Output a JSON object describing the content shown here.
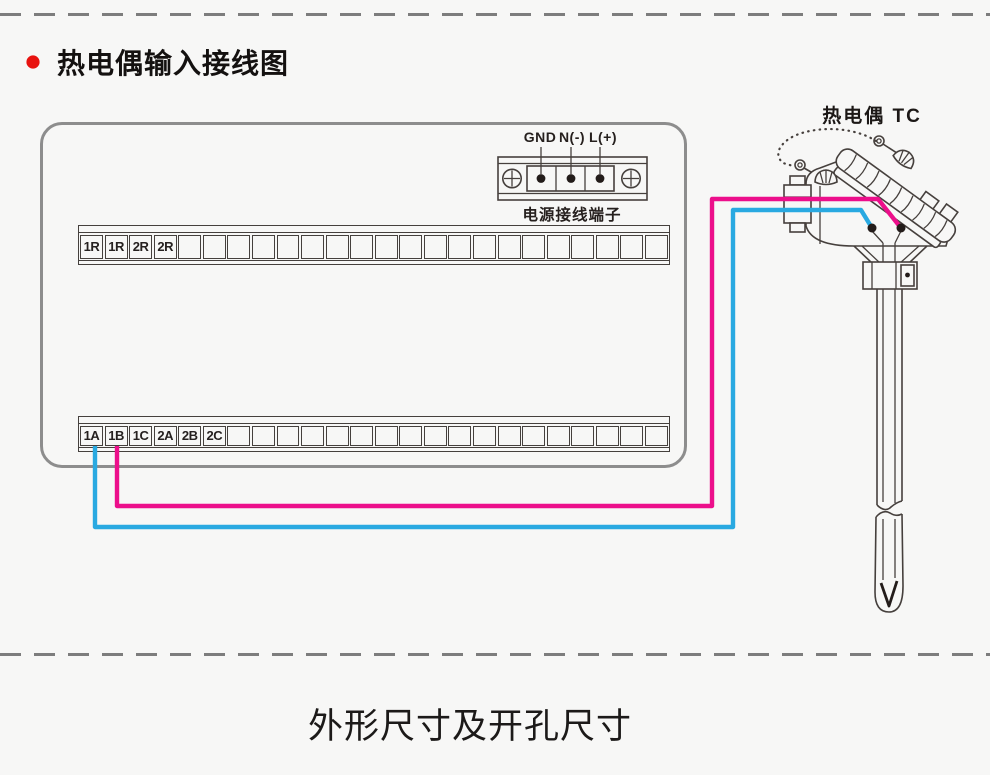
{
  "page": {
    "title": "热电偶输入接线图",
    "footer_heading": "外形尺寸及开孔尺寸"
  },
  "power_terminal": {
    "pin_labels": [
      "GND",
      "N(-)",
      "L(+)"
    ],
    "caption": "电源接线端子"
  },
  "sensor": {
    "label": "热电偶 TC"
  },
  "strips": {
    "top": {
      "cells": 24,
      "labels": [
        "1R",
        "1R",
        "2R",
        "2R"
      ]
    },
    "bottom": {
      "cells": 24,
      "labels": [
        "1A",
        "1B",
        "1C",
        "2A",
        "2B",
        "2C"
      ]
    }
  },
  "colors": {
    "wire_positive_pink": "#ec0f8b",
    "wire_negative_blue": "#29a9e1",
    "bullet_red": "#e8130f"
  }
}
